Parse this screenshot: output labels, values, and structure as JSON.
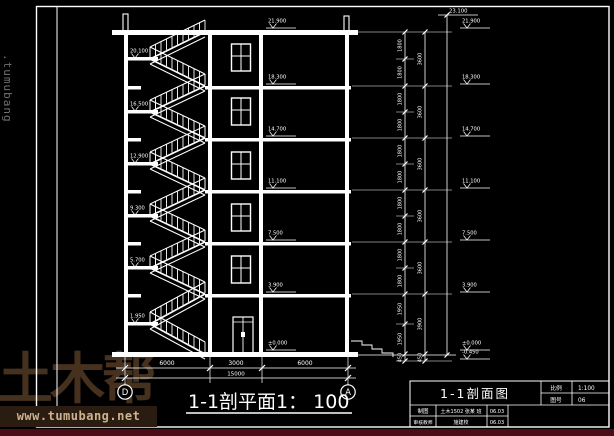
{
  "page": {
    "bg": "#000000",
    "line_color": "#ffffff"
  },
  "watermark": {
    "side_text": ".tumubang",
    "logo_text": "土木帮",
    "logo_url": "www.tumubang.net",
    "logo_color": "#46311f",
    "url_color": "#cdb38f",
    "url_band_color": "#2a1c11",
    "bottom_strip_color": "#4a0d18"
  },
  "caption": {
    "text": "1-1剖平面1： 100"
  },
  "axes": {
    "left": "D",
    "right": "A"
  },
  "dims_bottom": {
    "segments": [
      "6000",
      "3000",
      "6000"
    ],
    "total": "15000"
  },
  "dims_right": {
    "half_chain": [
      "1800",
      "1800",
      "1800",
      "1800",
      "1800",
      "1800",
      "1800",
      "1800",
      "1800",
      "1800",
      "1950",
      "1950",
      "450"
    ],
    "floor_chain": [
      "3600",
      "3600",
      "3600",
      "3600",
      "3600",
      "3900",
      "450"
    ],
    "parapet_elevation": "23.100"
  },
  "elevations": {
    "far_right": [
      "21.900",
      "18.300",
      "14.700",
      "11.100",
      "7.500",
      "3.900",
      "±0.000",
      "-0.450"
    ],
    "in_bay": [
      "21.900",
      "18.300",
      "14.700",
      "11.100",
      "7.500",
      "3.900",
      "±0.000"
    ],
    "landings": [
      "20.100",
      "16.500",
      "12.900",
      "9.300",
      "5.700",
      "1.950"
    ]
  },
  "title_block": {
    "title": "1-1剖面图",
    "scale_label": "比例",
    "scale_value": "1:100",
    "sheet_label": "图号",
    "sheet_value": "06",
    "rows": [
      {
        "label": "制图",
        "value": "土木1502 张某 班",
        "date": "06.03"
      },
      {
        "label": "审核教师",
        "value": "施建校",
        "date": "06.03"
      }
    ]
  }
}
